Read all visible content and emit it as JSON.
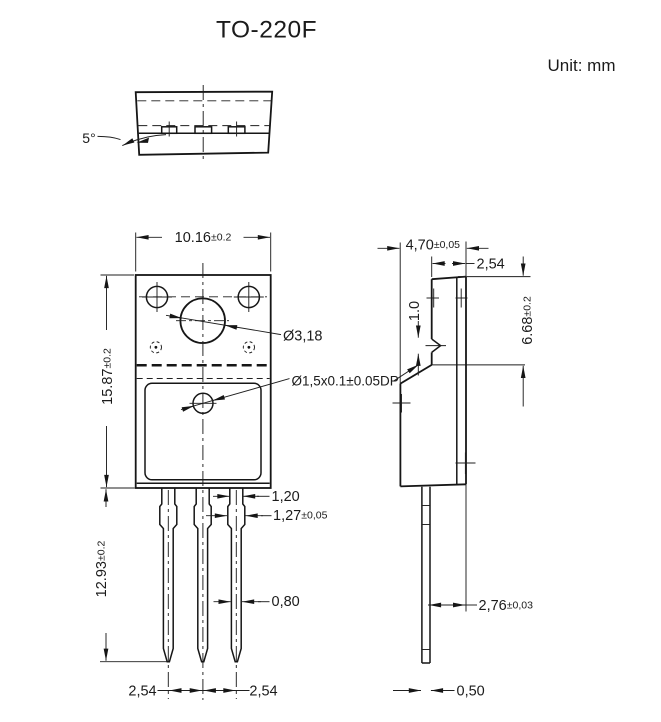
{
  "title": "TO-220F",
  "unit_label": "Unit: mm",
  "colors": {
    "line": "#1b1b1b",
    "background": "#ffffff"
  },
  "top_view": {
    "angle_label": "5°"
  },
  "front_view": {
    "width": {
      "value": "10.16",
      "tol": "±0.2"
    },
    "height": {
      "value": "15.87",
      "tol": "±0.2"
    },
    "lead_length": {
      "value": "12.93",
      "tol": "±0.2"
    },
    "mount_hole_label": "Ø3,18",
    "dimple_label": "Ø1,5x0.1±0.05DP",
    "lead_base_width": "1,20",
    "lead_shoulder_width": {
      "value": "1,27",
      "tol": "±0,05"
    },
    "lead_width": "0,80",
    "pitch_left": "2,54",
    "pitch_right": "2,54"
  },
  "side_view": {
    "body_thickness": {
      "value": "4,70",
      "tol": "±0,05"
    },
    "tab_thickness": "2,54",
    "tab_height": {
      "value": "6.68",
      "tol": "±0.2"
    },
    "dimple_height": "1.0",
    "lead_offset": {
      "value": "2,76",
      "tol": "±0,03"
    },
    "lead_thickness": "0,50"
  }
}
